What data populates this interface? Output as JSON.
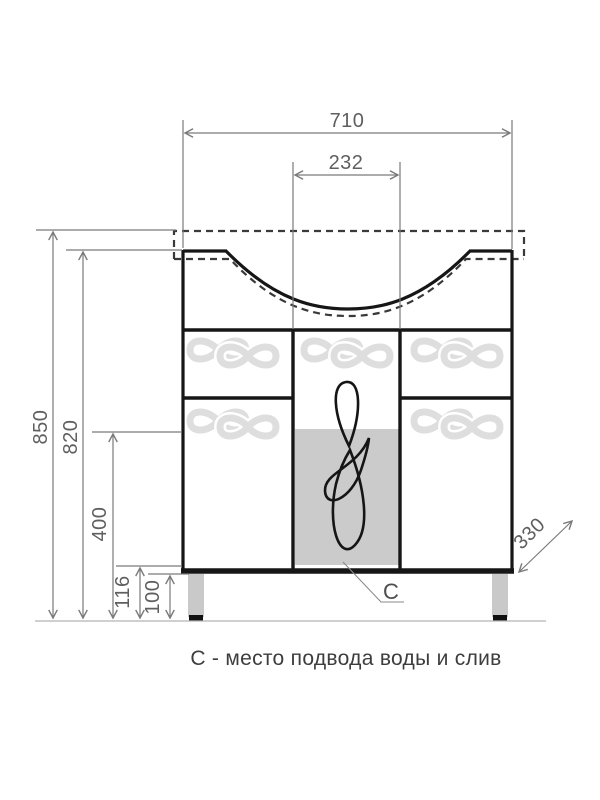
{
  "drawing": {
    "caption": "С - место подвода воды и слив",
    "marker": {
      "label": "C"
    },
    "dimensions": {
      "overall_width": "710",
      "basin_drain_width": "232",
      "overall_height": "850",
      "cabinet_height": "820",
      "service_height": "400",
      "bottom_height": "116",
      "leg_height": "100",
      "depth": "330"
    },
    "colors": {
      "outline": "#161616",
      "dashed_hidden_line": "#3a3a3a",
      "dimension_lines": "#7a7a7a",
      "dimension_text": "#5f5f5f",
      "service_zone_fill": "#cbcbcb",
      "leg_fill": "#c9c9c9",
      "ground_line": "#b5b5b5",
      "motif": "#dedede"
    }
  }
}
